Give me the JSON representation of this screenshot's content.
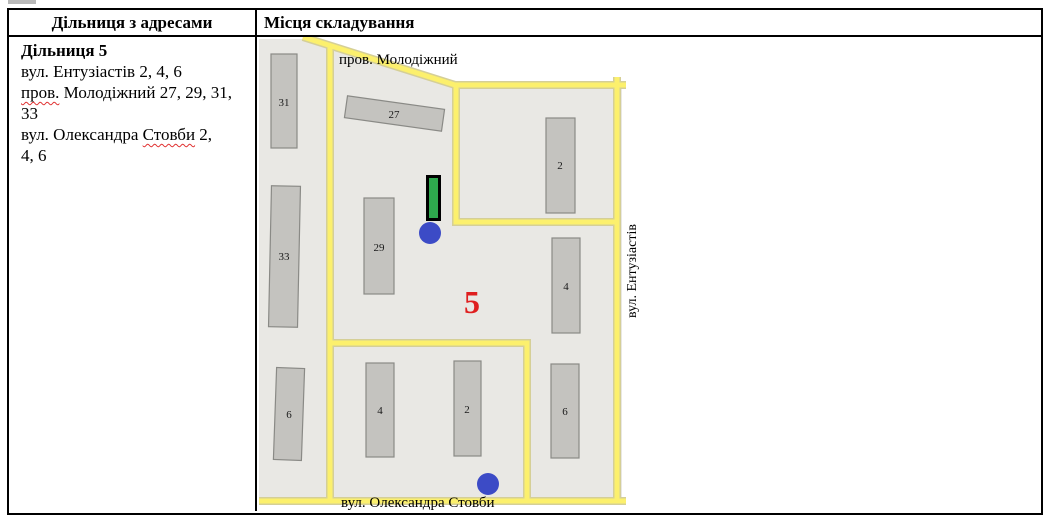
{
  "table": {
    "header": {
      "col1": "Дільниця з адресами",
      "col2": "Місця складування"
    }
  },
  "district": {
    "title": "Дільниця 5",
    "address_visual_lines": [
      {
        "segments": [
          {
            "text": "вул. Ентузіастів 2, 4, 6",
            "misspelled": false
          }
        ]
      },
      {
        "segments": [
          {
            "text": "пров.",
            "misspelled": true
          },
          {
            "text": " Молодіжний 27, 29, 31,",
            "misspelled": false
          }
        ]
      },
      {
        "segments": [
          {
            "text": "33",
            "misspelled": false
          }
        ]
      },
      {
        "segments": [
          {
            "text": "вул. Олександра ",
            "misspelled": false
          },
          {
            "text": "Стовби",
            "misspelled": true
          },
          {
            "text": " 2,",
            "misspelled": false
          }
        ]
      },
      {
        "segments": [
          {
            "text": "4, 6",
            "misspelled": false
          }
        ]
      }
    ]
  },
  "map": {
    "district_number": "5",
    "streets": {
      "top": "пров. Молодіжний",
      "right": "вул. Ентузіастів",
      "bottom": "вул. Олександра Стовби"
    },
    "building_labels": [
      "31",
      "27",
      "2",
      "33",
      "29",
      "4",
      "6",
      "4",
      "2",
      "6"
    ],
    "markers": {
      "storage_rect_color": "#2ea84d",
      "container_circle_color": "#3c4bc6",
      "container_circle_count": 2
    },
    "colors": {
      "road": "#fcf06d",
      "road_casing": "#d5cf97",
      "building_fill": "#c4c3bf",
      "building_stroke": "#8a8a86",
      "map_bg": "#e9e8e4",
      "district_number_red": "#df1f1f"
    }
  }
}
